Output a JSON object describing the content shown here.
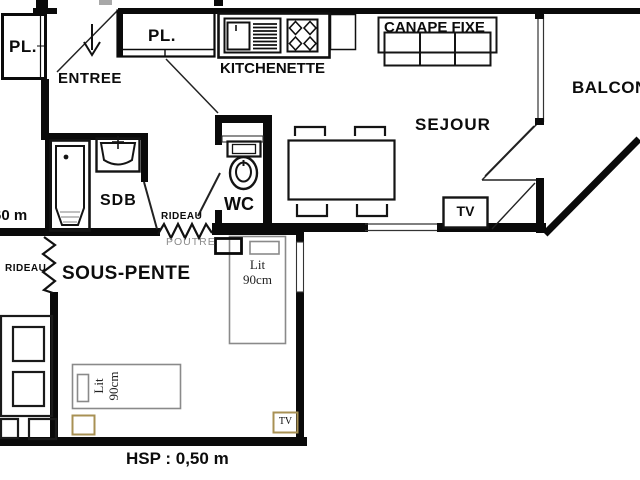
{
  "figure": {
    "kind": "apartment floor plan",
    "width_px": 640,
    "height_px": 480
  },
  "colors": {
    "wall": "#0a0a0a",
    "background": "#ffffff",
    "bed_outline": "#8a8a8a",
    "tan_outline": "#a89154",
    "poutre_text": "#8c8c8c"
  },
  "rooms": {
    "entree": "ENTREE",
    "kitchenette": "KITCHENETTE",
    "sejour": "SEJOUR",
    "balcon": "BALCON",
    "sdb": "SDB",
    "wc": "WC",
    "sous_pente": "SOUS-PENTE"
  },
  "closets": {
    "pl_entry": "PL.",
    "pl_hall": "PL."
  },
  "furniture": {
    "canape_fixe": "CANAPE FIXE",
    "tv_sejour": "TV",
    "tv_sous_pente": "TV",
    "bed_vertical": {
      "line1": "Lit",
      "line2": "90cm"
    },
    "bed_horizontal": {
      "line1": "Lit",
      "line2": "90cm"
    }
  },
  "annotations": {
    "rideau_hall": "RIDEAU",
    "poutre": "POUTRE",
    "rideau_alcove": "RIDEAU",
    "dimension_left": "60 m",
    "hsp": "HSP : 0,50 m"
  }
}
